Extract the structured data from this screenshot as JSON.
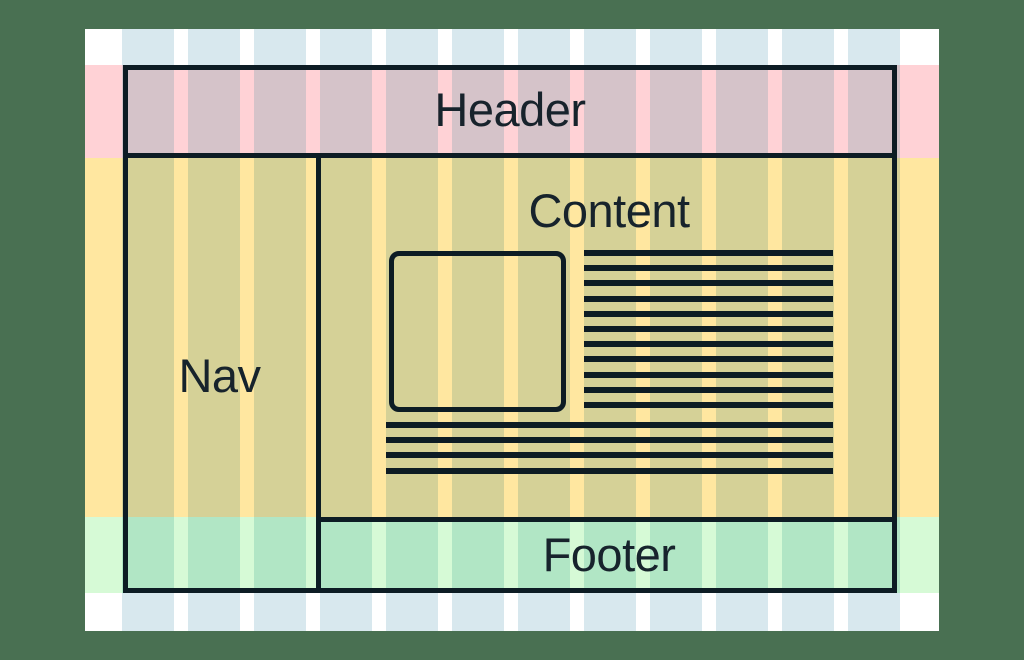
{
  "diagram": {
    "type": "webpage-layout-grid",
    "labels": {
      "header": "Header",
      "nav": "Nav",
      "content": "Content",
      "footer": "Footer"
    },
    "grid": {
      "column_count": 12
    },
    "placeholders": {
      "right_text_lines": 11,
      "bottom_text_lines": 4,
      "image_box": 1
    },
    "colors": {
      "canvas_bg": "#497052",
      "page_bg": "#ffffff",
      "margin_column": "#d8e8ee",
      "header_band": "#ffd2d6",
      "header_column": "#d5c3c9",
      "main_band": "#ffe7a0",
      "main_column": "#d5d197",
      "footer_band": "#d6fad6",
      "footer_column": "#b1e6c5",
      "outline": "#0d1c24",
      "text": "#17232c"
    }
  }
}
